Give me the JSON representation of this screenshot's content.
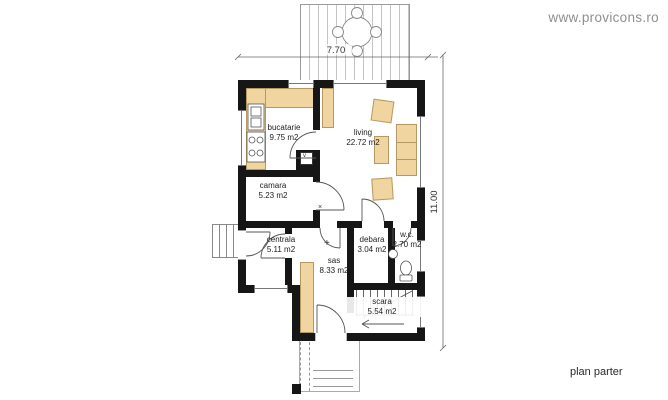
{
  "watermark": "www.provicons.ro",
  "caption": "plan parter",
  "dimensions": {
    "width": "7.70",
    "height": "11.00"
  },
  "rooms": {
    "bucatarie": {
      "name": "bucatarie",
      "area": "9.75 m2"
    },
    "living": {
      "name": "living",
      "area": "22.72 m2"
    },
    "camara": {
      "name": "camara",
      "area": "5.23 m2"
    },
    "centrala": {
      "name": "centrala",
      "area": "5.11 m2"
    },
    "debara": {
      "name": "debara",
      "area": "3.04 m2"
    },
    "wc": {
      "name": "w.c.",
      "area": "2.70 m2"
    },
    "sas": {
      "name": "sas",
      "area": "8.33 m2"
    },
    "scara": {
      "name": "scara",
      "area": "5.54 m2"
    }
  },
  "markers": {
    "cross": "×",
    "plus": "+",
    "shaft": "v"
  },
  "colors": {
    "wall": "#161616",
    "furniture": "#f0d5a0",
    "furniture_outline": "#b49a62",
    "plan_line": "#666666",
    "watermark": "#8f8f8f",
    "text": "#1d1d1d"
  }
}
